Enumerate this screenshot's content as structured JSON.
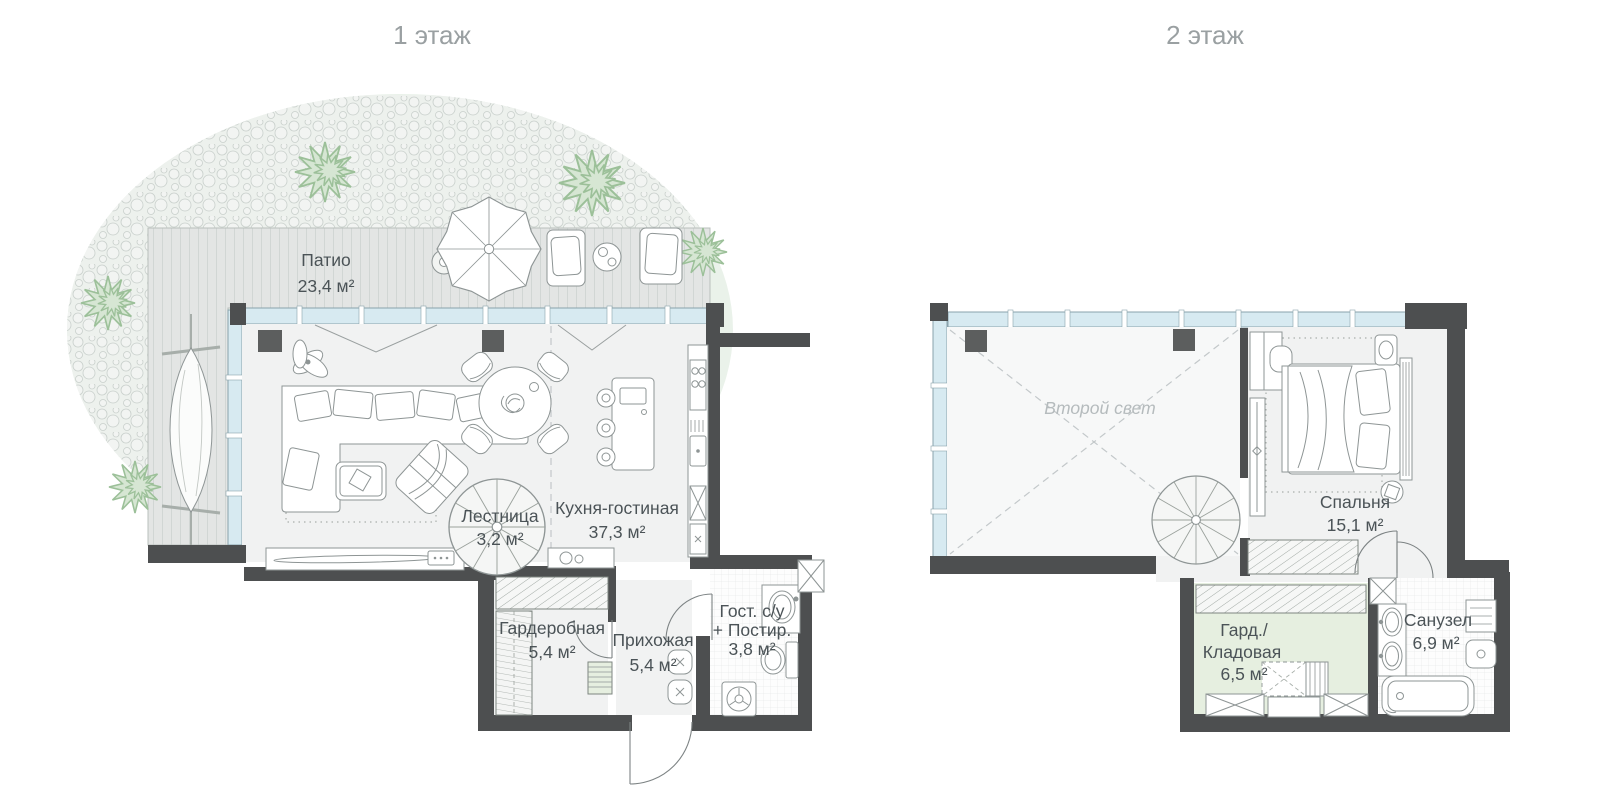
{
  "floor1": {
    "title": "1 этаж",
    "labels": {
      "patio": {
        "name": "Патио",
        "area": "23,4 м²"
      },
      "kitchen_living": {
        "name": "Кухня-гостиная",
        "area": "37,3 м²"
      },
      "stairs": {
        "name": "Лестница",
        "area": "3,2 м²"
      },
      "wardrobe": {
        "name": "Гардеробная",
        "area": "5,4 м²"
      },
      "hallway": {
        "name": "Прихожая",
        "area": "5,4 м²"
      },
      "guest_bath": {
        "name_line1": "Гост. с/у",
        "name_line2": "+ Постир.",
        "area": "3,8 м²"
      }
    }
  },
  "floor2": {
    "title": "2 этаж",
    "labels": {
      "void": {
        "name": "Второй свет"
      },
      "bedroom": {
        "name": "Спальня",
        "area": "15,1 м²"
      },
      "storage": {
        "name_line1": "Гард./",
        "name_line2": "Кладовая",
        "area": "6,5 м²"
      },
      "bathroom": {
        "name": "Санузел",
        "area": "6,9 м²"
      }
    }
  },
  "colors": {
    "wall": "#4d4f50",
    "window": "#d7eaf1",
    "window_frame": "#8aa3ac",
    "deck": "#e3e5e4",
    "deck_stripe": "#cfd5d2",
    "lawn": "#eaf2ea",
    "pebble_bg": "#edf1ed",
    "pebble": "#c9d0cc",
    "tree_fill": "#d6e6d3",
    "tree_stroke": "#9cc099",
    "room": "#f1f2f2",
    "void": "#f7f8f8",
    "storage": "#e6efe0",
    "furniture": "#8e9595",
    "dark_item": "#5c5e5e",
    "label": "#4b5357",
    "muted_label": "#b5bbbd",
    "title": "#9aa0a2",
    "rug_dot": "#aab0ac",
    "dash": "#c3c8ca"
  }
}
